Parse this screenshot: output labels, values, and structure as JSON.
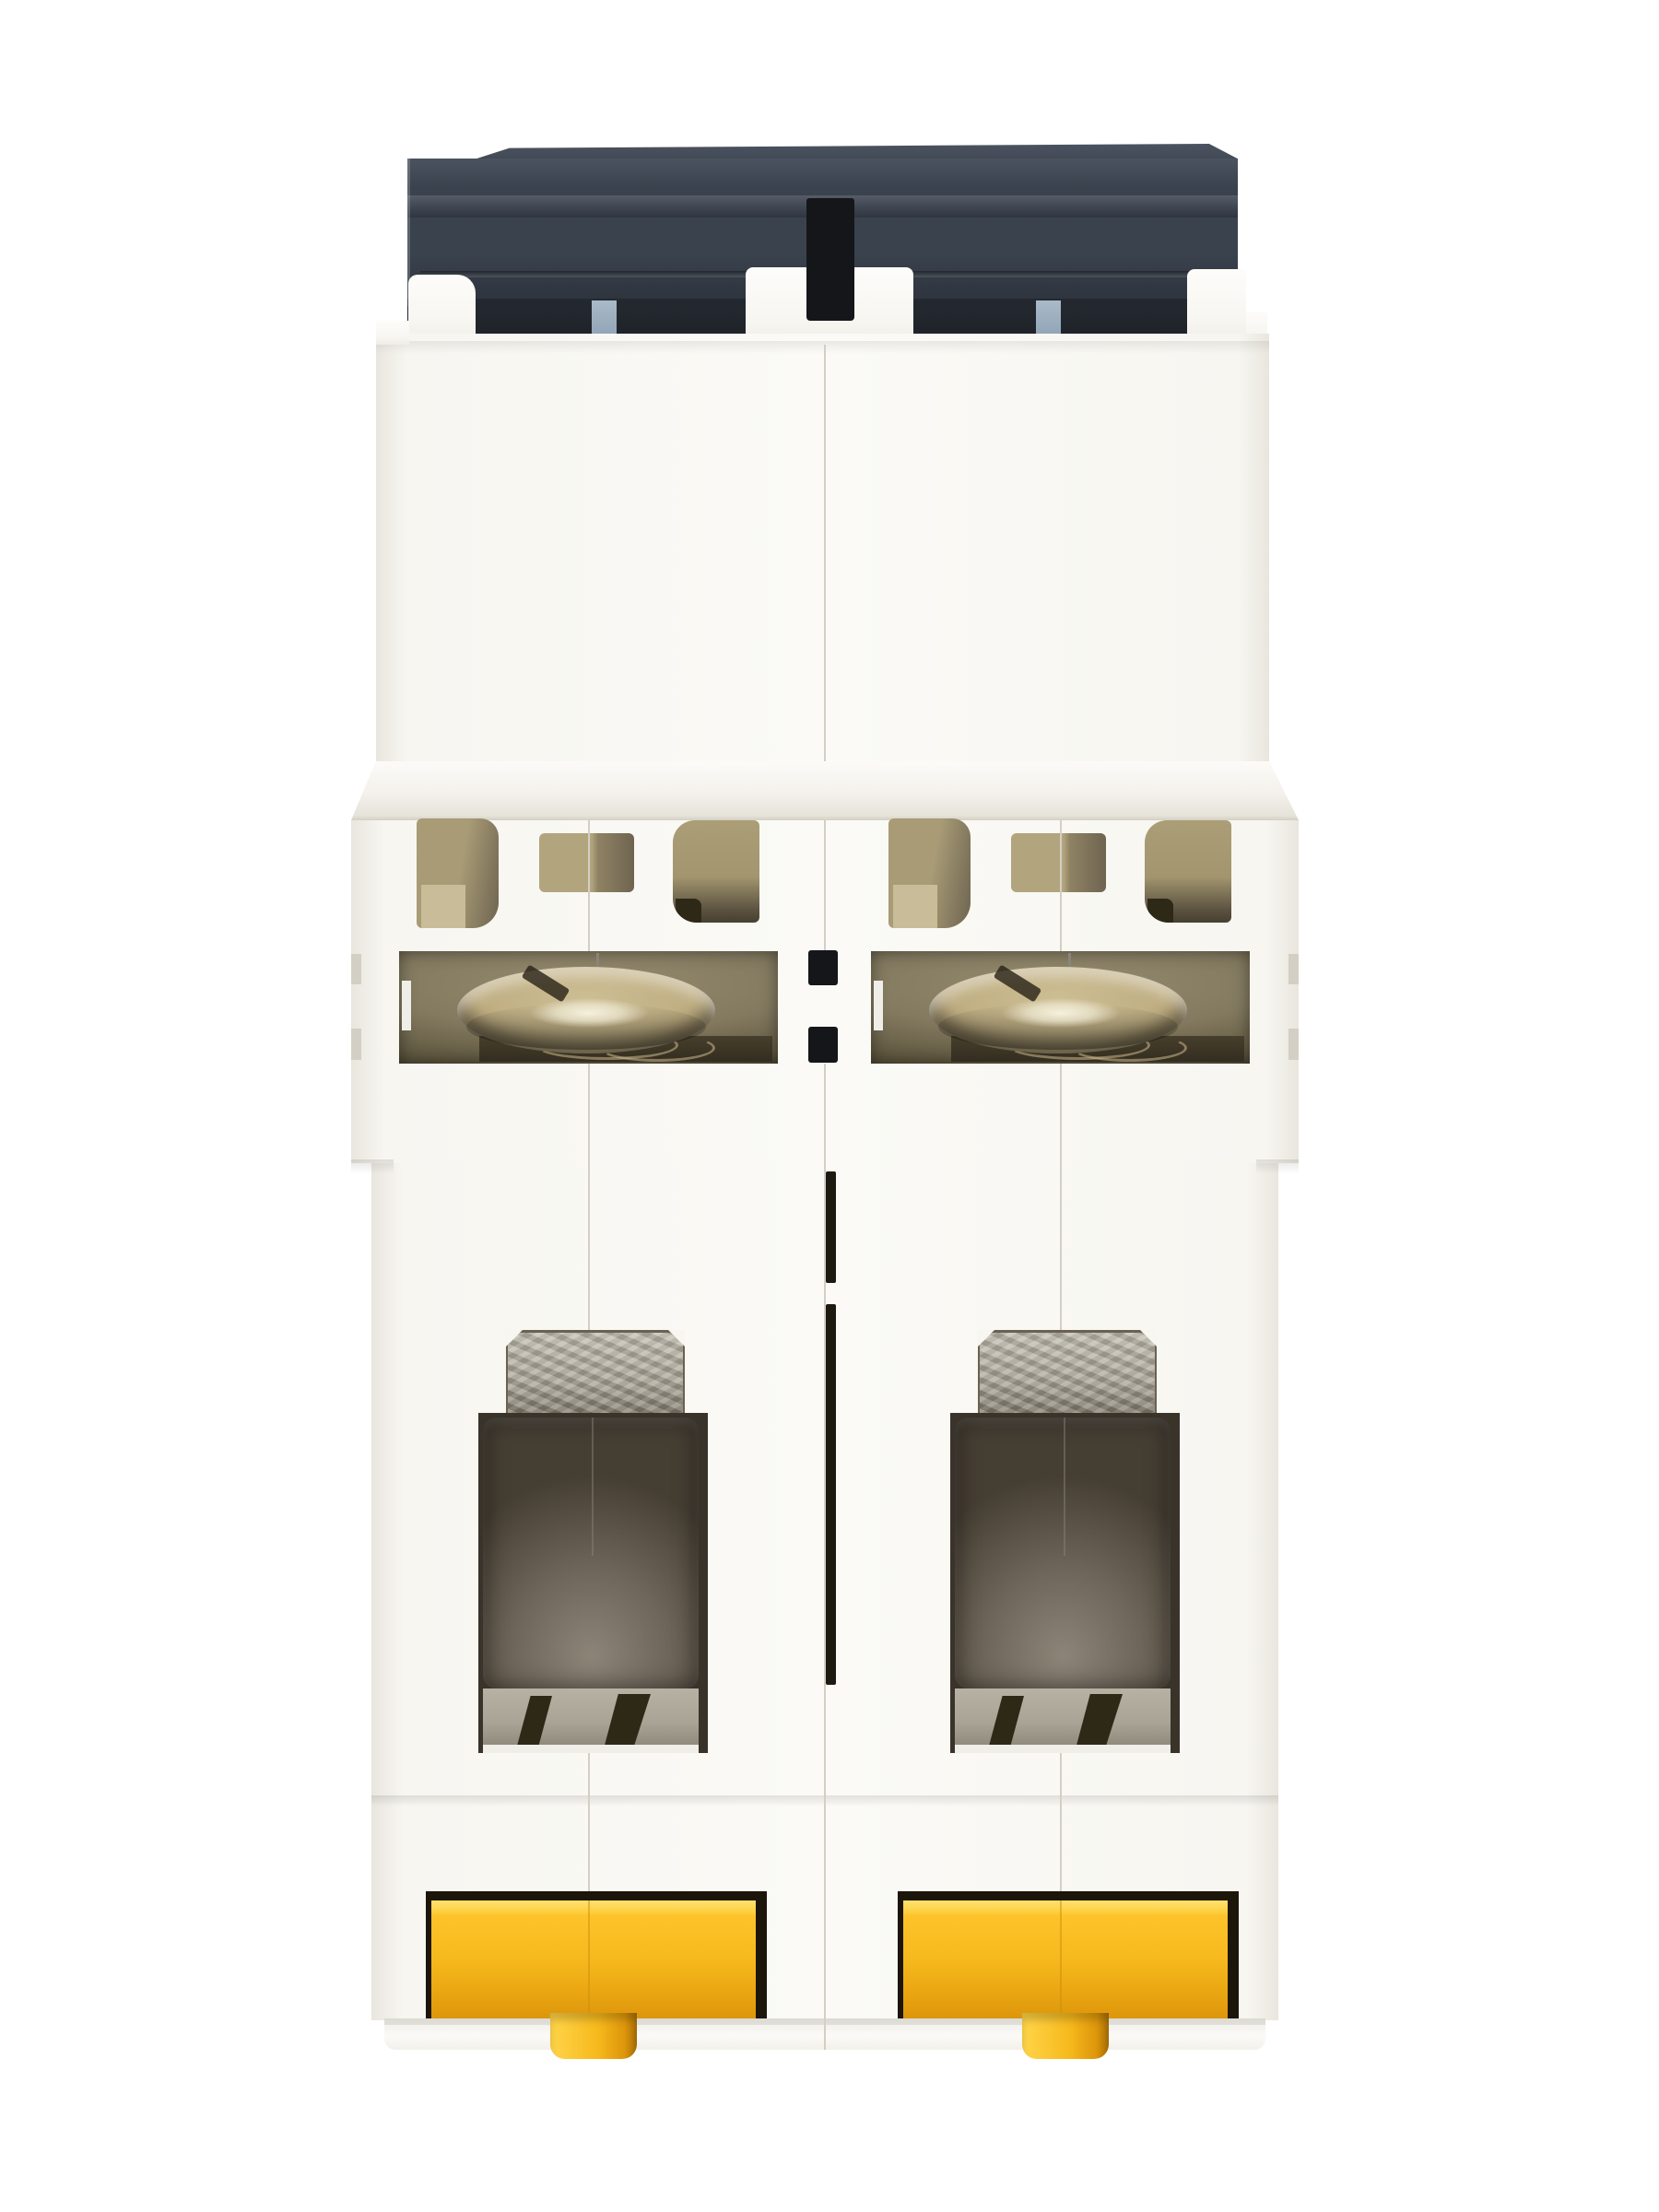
{
  "scene": {
    "type": "product-photograph",
    "subject": "Two-pole miniature circuit breaker (MCB) viewed from the bottom / DIN-rail side",
    "orientation": "dark actuator housing at top, screw terminals and yellow DIN-rail clips at bottom",
    "background": "plain white studio backdrop",
    "pole_count": 2
  },
  "parts": {
    "top_housing": "charcoal actuator housing with stepped profile",
    "toggle_slot": "dark slot at housing centerline",
    "blue_tabs": "two blue-gray latch tabs under housing",
    "upper_body": "white molded body, two pole modules with center seam",
    "vent_openings": "six tan ventilation openings per row",
    "terminal_screws": "two nickel terminal screws seen through windows",
    "cage_windows": "two smoked terminal-cage windows with galvanized clamp bars",
    "din_clips": "two yellow spring DIN-rail clips with pull tabs"
  },
  "colors": {
    "bg": "#ffffff",
    "charcoal_hi": "#4a535f",
    "charcoal": "#3a424e",
    "charcoal_dk": "#303640",
    "charcoal_dk2": "#272c34",
    "slot_black": "#15161a",
    "blue_tab": "#a9bac9",
    "body_white": "#f7f6f1",
    "body_shade": "#e9e6de",
    "seam_light": "#d3cfc4",
    "seam_dark": "#8a857a",
    "tan_light": "#c8bd98",
    "tan": "#a89b76",
    "tan_dark": "#6e6450",
    "cavity_dark": "#46402f",
    "nickel_light": "#f6f1dd",
    "nickel": "#cdbe94",
    "nickel_dark": "#8a7a58",
    "plate_dark": "#332d20",
    "galv_light": "#c2bdb0",
    "galv": "#aaa496",
    "galv_dark": "#7e786a",
    "smoke_edge": "#453e33",
    "smoke_mid": "#6e665a",
    "smoke_light": "#8d8478",
    "clamp_gap": "#2e2817",
    "recess_black": "#1c1509",
    "yellow_light": "#ffd54a",
    "yellow": "#f6b91d",
    "yellow_dark": "#dd960b",
    "yellow_deep": "#a96f04"
  }
}
